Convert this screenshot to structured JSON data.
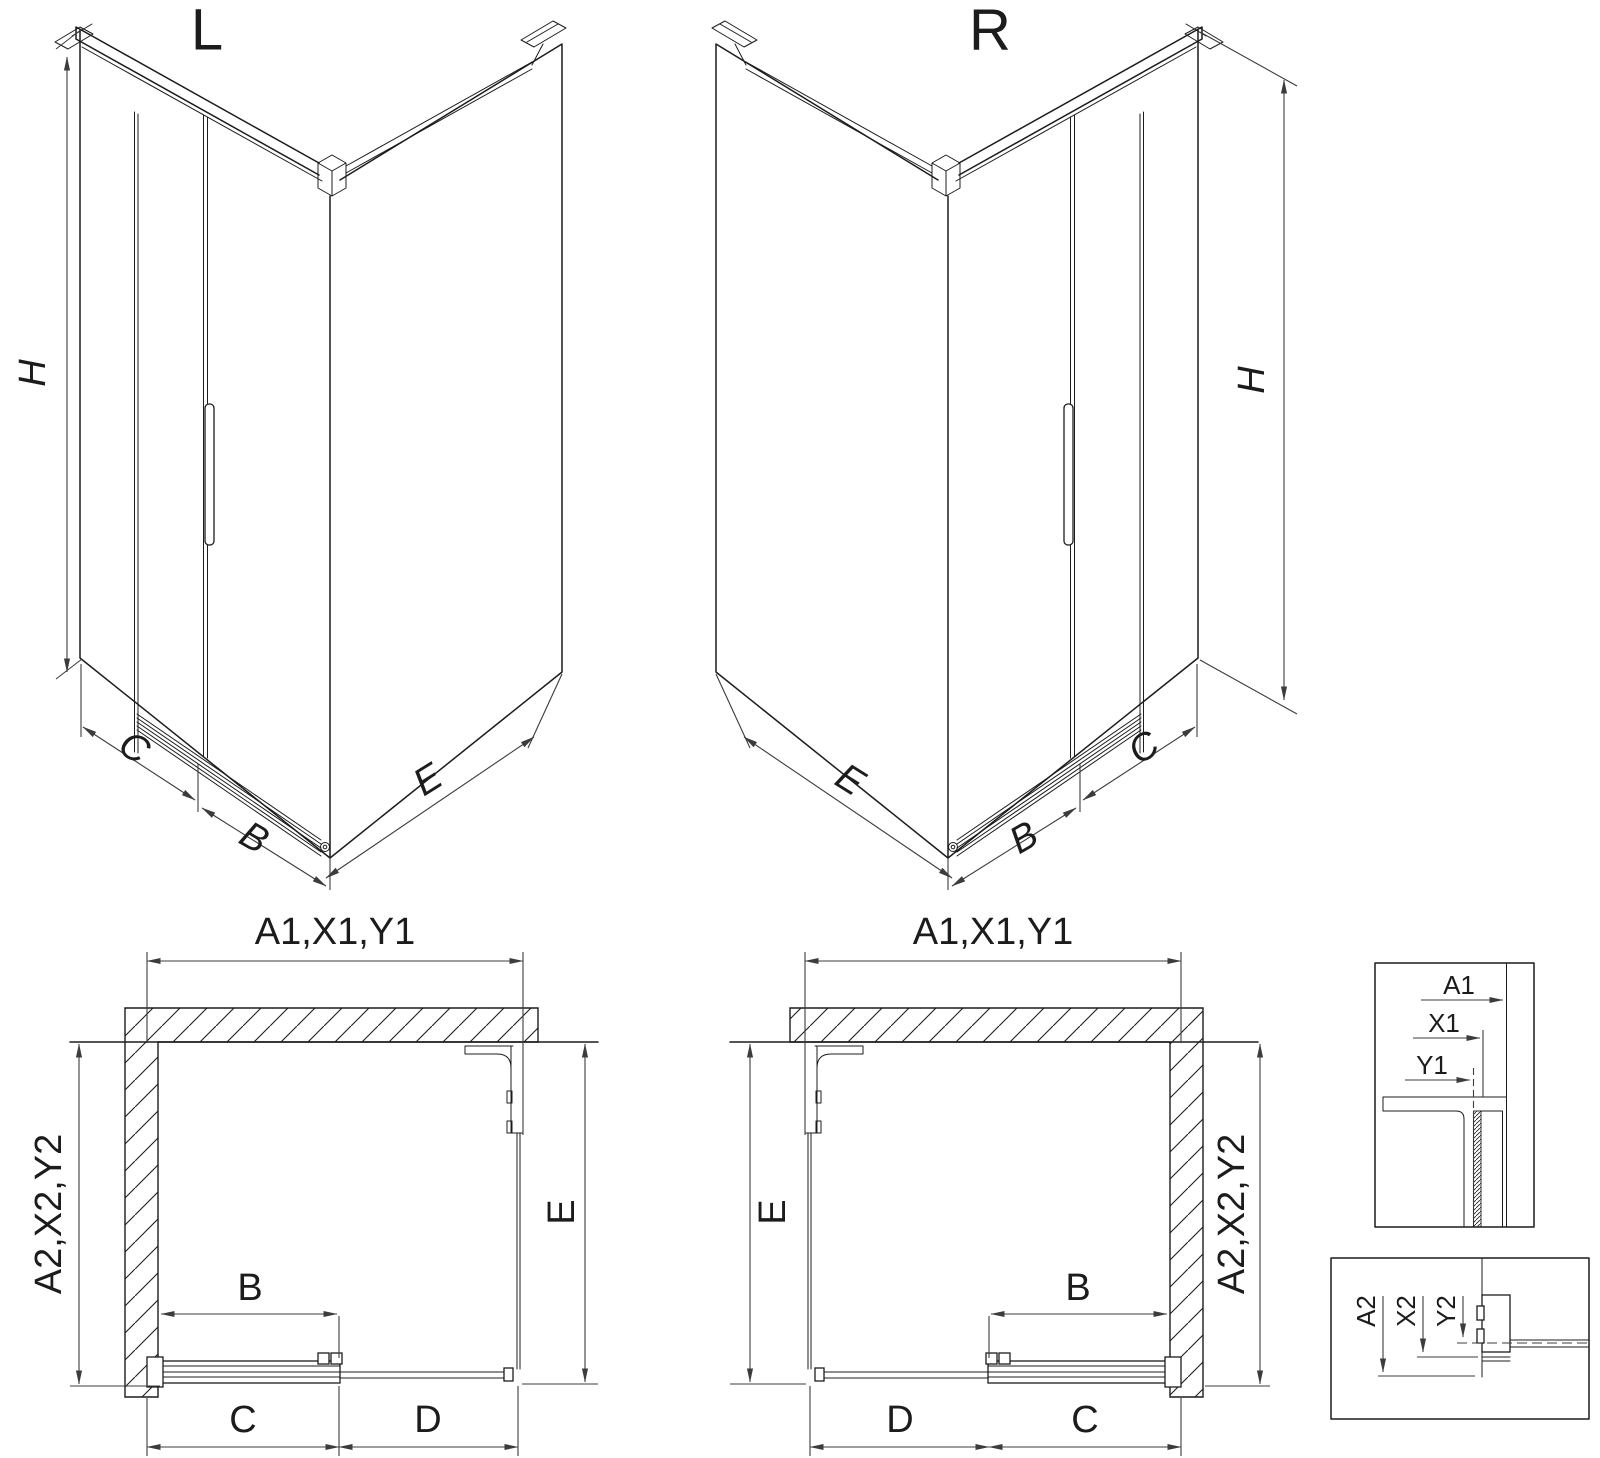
{
  "drawing": {
    "colors": {
      "background": "#ffffff",
      "line": "#1c1c1c",
      "dim": "#3c3c3c"
    },
    "iso_left": {
      "title": "L",
      "height_label": "H",
      "panel_label": "C",
      "door_label": "B",
      "return_label": "E"
    },
    "iso_right": {
      "title": "R",
      "height_label": "H",
      "panel_label": "C",
      "door_label": "B",
      "return_label": "E"
    },
    "plan_left": {
      "width_label": "A1,X1,Y1",
      "depth_label": "A2,X2,Y2",
      "return_label": "E",
      "door_label": "B",
      "fixed_label": "C",
      "opening_label": "D"
    },
    "plan_right": {
      "width_label": "A1,X1,Y1",
      "depth_label": "A2,X2,Y2",
      "return_label": "E",
      "door_label": "B",
      "fixed_label": "C",
      "opening_label": "D"
    },
    "detail_width": {
      "labels": [
        "A1",
        "X1",
        "Y1"
      ]
    },
    "detail_depth": {
      "labels": [
        "A2",
        "X2",
        "Y2"
      ]
    }
  }
}
